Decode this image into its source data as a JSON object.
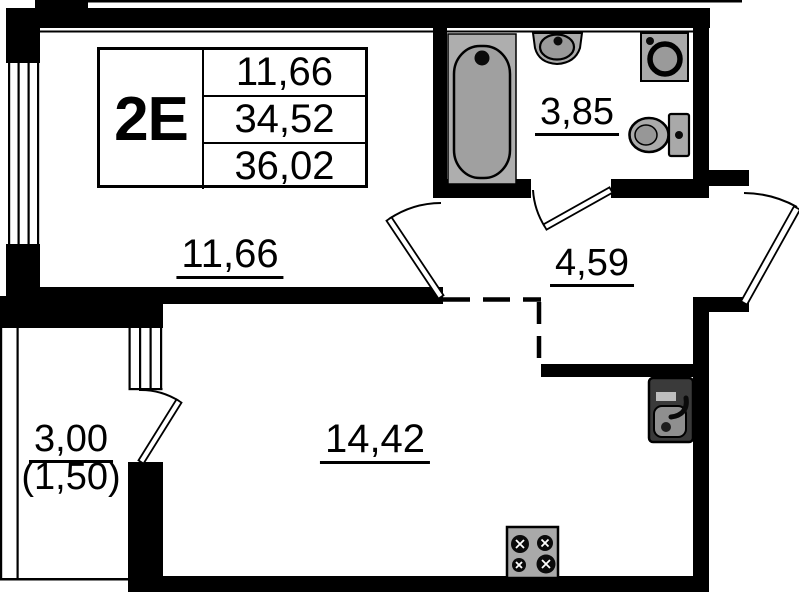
{
  "floor_plan": {
    "title_block": {
      "unit_type": "2E",
      "row1": "11,66",
      "row2": "34,52",
      "row3": "36,02"
    },
    "areas": {
      "living_room": "11,66",
      "bathroom": "3,85",
      "hallway": "4,59",
      "kitchen_living_room": "14,42",
      "balcony": "3,00",
      "balcony_reduced": "(1,50)"
    },
    "fixtures": [
      "bathtub",
      "wash-basin",
      "washing-machine",
      "toilet",
      "kitchen-sink",
      "stove"
    ],
    "colors": {
      "wall": "#000000",
      "background": "#ffffff",
      "fixture_fill": "#a9a9a9",
      "fixture_inner": "#999999",
      "sink_dark": "#3a3a3a"
    }
  }
}
